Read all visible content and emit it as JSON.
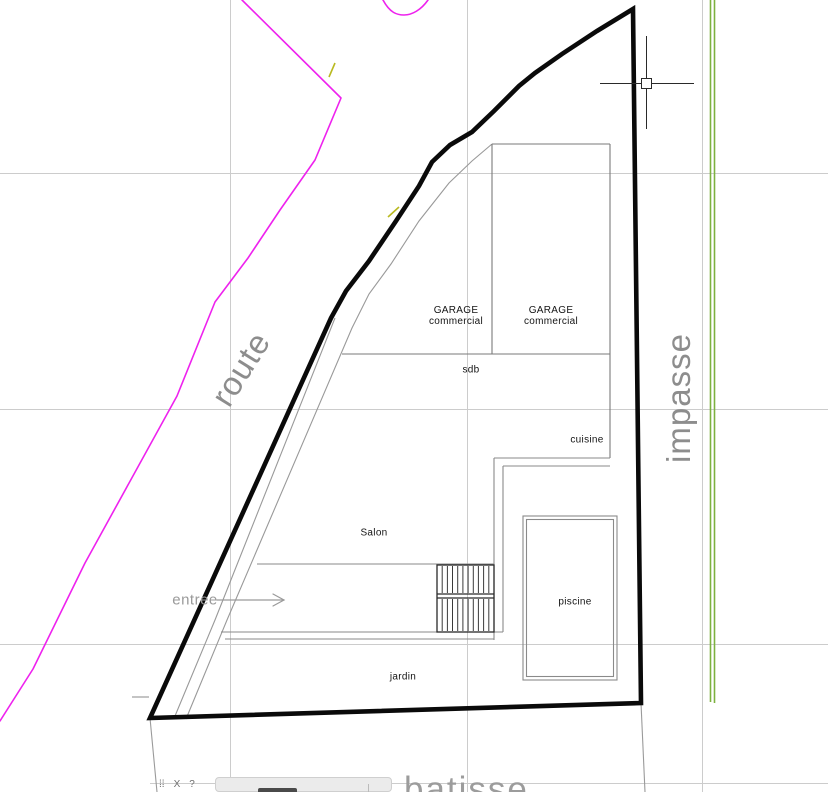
{
  "canvas": {
    "rooms": {
      "garage_left_line1": "GARAGE",
      "garage_left_line2": "commercial",
      "garage_right_line1": "GARAGE",
      "garage_right_line2": "commercial",
      "sdb": "sdb",
      "cuisine": "cuisine",
      "salon": "Salon",
      "piscine": "piscine",
      "jardin": "jardin",
      "entree": "entree"
    },
    "streets": {
      "route": "route",
      "impasse": "impasse",
      "batisse": "batisse"
    }
  },
  "colors": {
    "parcel_boundary": "#0a0a0a",
    "road_polyline_magenta": "#ee22ee",
    "impasse_edge_green": "#7db13f",
    "street_text_gray": "#8d8d8d",
    "wall_gray": "#8a8a8a",
    "grid_gray": "#cccccc",
    "survey_fleck_olive": "#b9b920"
  },
  "command_bar": {
    "axis_label": "X",
    "help_glyph": "?"
  }
}
